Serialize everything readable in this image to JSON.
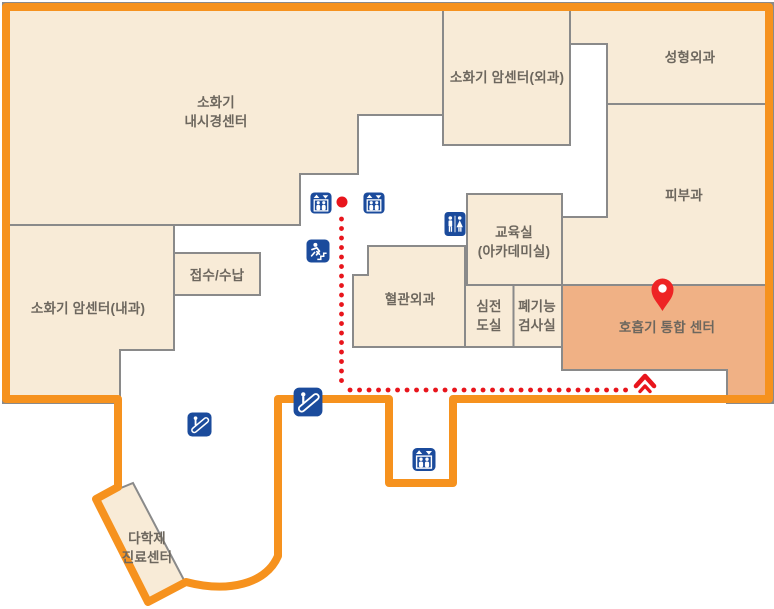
{
  "map_title": "hospital-floor-guide-map",
  "rooms": [
    {
      "id": "digestive-endoscopy-center",
      "label": "소화기",
      "label2": "내시경센터",
      "highlighted": false
    },
    {
      "id": "digestive-cancer-center-surgery",
      "label": "소화기 암센터(외과)",
      "highlighted": false
    },
    {
      "id": "plastic-surgery",
      "label": "성형외과",
      "highlighted": false
    },
    {
      "id": "dermatology",
      "label": "피부과",
      "highlighted": false
    },
    {
      "id": "digestive-cancer-center-internal",
      "label": "소화기 암센터(내과)",
      "highlighted": false
    },
    {
      "id": "reception-payment",
      "label": "접수/수납",
      "highlighted": false
    },
    {
      "id": "education-room",
      "label": "교육실",
      "label2": "(아카데미실)",
      "highlighted": false
    },
    {
      "id": "vascular-surgery",
      "label": "혈관외과",
      "highlighted": false
    },
    {
      "id": "ecg-room",
      "label": "심전",
      "label2": "도실",
      "highlighted": false
    },
    {
      "id": "pulmonary-function-test-room",
      "label": "폐기능",
      "label2": "검사실",
      "highlighted": false
    },
    {
      "id": "respiratory-integrated-center",
      "label": "호흡기 통합 센터",
      "highlighted": true
    },
    {
      "id": "multidisciplinary-care-center",
      "label": "다학제",
      "label2": "진료센터",
      "highlighted": false
    }
  ],
  "icons": [
    {
      "type": "elevator"
    },
    {
      "type": "elevator"
    },
    {
      "type": "emergency-stairs"
    },
    {
      "type": "restroom"
    },
    {
      "type": "escalator"
    },
    {
      "type": "escalator"
    },
    {
      "type": "elevator"
    }
  ],
  "route": {
    "style": "dotted",
    "destination": "호흡기 통합 센터",
    "marker": "location-pin"
  },
  "colors": {
    "outline_orange": "#f6921e",
    "room_fill": "#f8ebd7",
    "room_border": "#8a8a8a",
    "highlight_fill": "#f0b185",
    "icon_blue": "#1b4b9c",
    "route_red": "#e8151c",
    "pin_red": "#ee2424",
    "label_color": "#6d675e"
  }
}
